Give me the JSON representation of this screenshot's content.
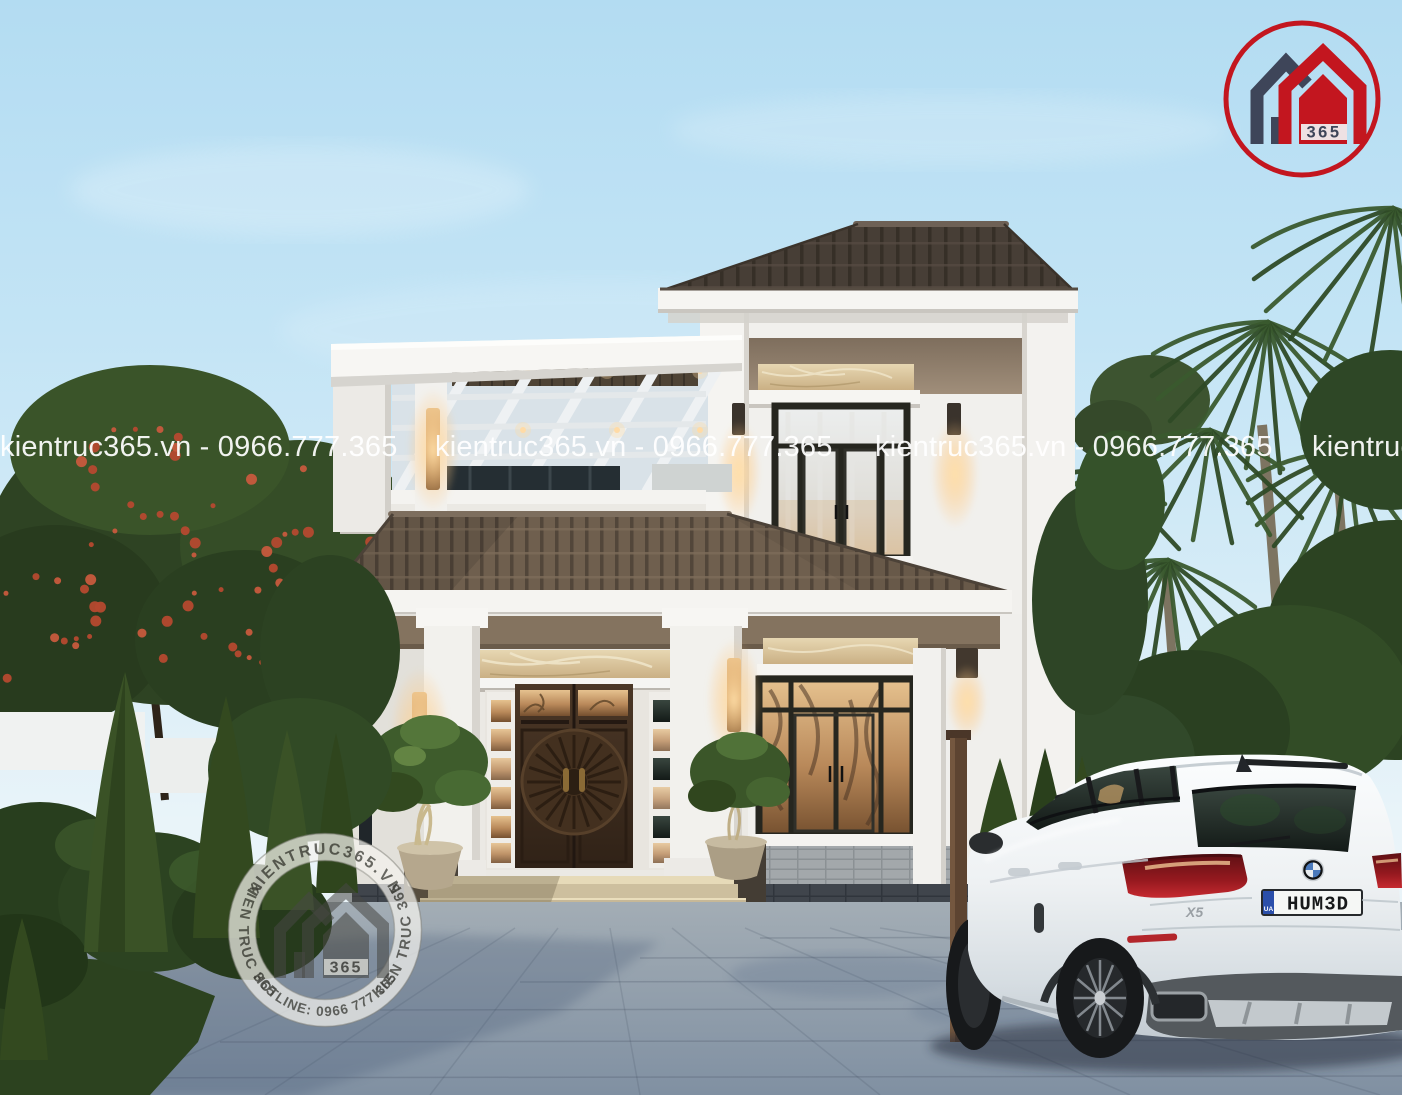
{
  "watermark": {
    "text": "kientruc365.vn - 0966.777.365"
  },
  "branding": {
    "logo": {
      "badge": "365",
      "ring_color": "#c3161f",
      "house_navy": "#3e4559",
      "house_red": "#c3161f"
    },
    "stamp": {
      "arc_top": "KIENTRUC365.VN",
      "arc_left": "KIEN TRUC 365",
      "arc_right": "KIEN TRUC 365",
      "arc_bottom": "HOTLINE: 0966 777 365",
      "badge": "365"
    }
  },
  "car": {
    "plate": "HUM3D",
    "plate_country": "UA",
    "model_badge": "X5"
  },
  "colors": {
    "sky_top": "#b3dcf2",
    "sky_bottom": "#eef6f9",
    "roof_dark": "#4e443b",
    "roof_mid": "#70604f",
    "wall_white": "#f3f2ef",
    "band_taupe": "#8f7f6e",
    "marble": "#dcc9a2",
    "door_wood": "#3a2a1e",
    "frame_black": "#26261f",
    "glass_amber": "#c89a6a",
    "pavement": "#8e9cab",
    "foliage_dark": "#2c4322",
    "flower_red": "#b5492f",
    "car_white": "#eef1f3",
    "taillight_red": "#a21d23",
    "plate_blue": "#2b4faa"
  }
}
